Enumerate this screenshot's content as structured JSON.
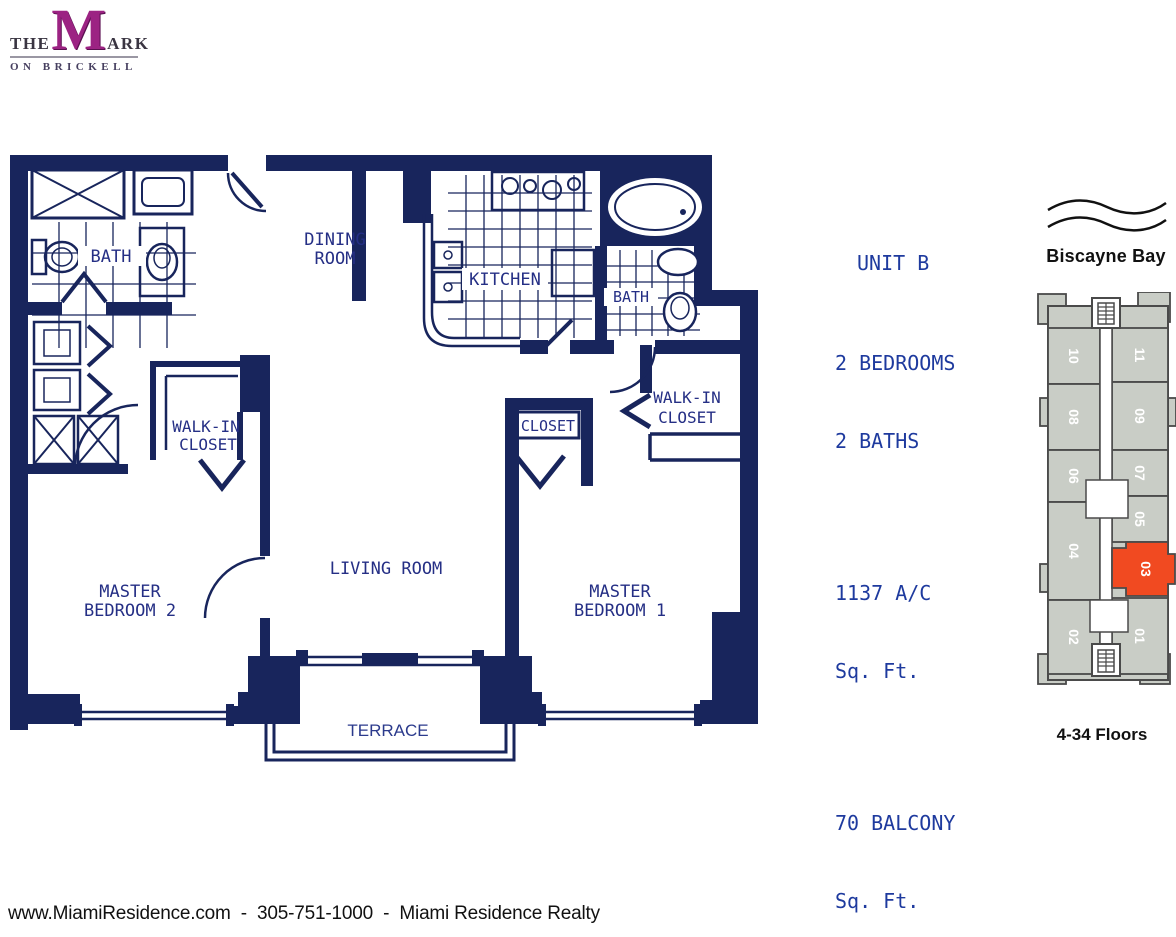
{
  "logo": {
    "word_the": "THE",
    "word_m": "M",
    "word_ark": "ARK",
    "tagline": "ON BRICKELL",
    "m_color": "#9c2383"
  },
  "unit_info": {
    "title": "UNIT B",
    "line_bedrooms": "2 BEDROOMS",
    "line_baths": "2 BATHS",
    "area_value": "1137 A/C",
    "area_unit": "Sq. Ft.",
    "balcony_value": "70 BALCONY",
    "balcony_unit": "Sq. Ft.",
    "text_color": "#1e3a9e"
  },
  "floor_plan": {
    "wall_color": "#18255c",
    "label_color": "#252f85",
    "labels": {
      "bath_left": "BATH",
      "dining_line1": "DINING",
      "dining_line2": "ROOM",
      "kitchen": "KITCHEN",
      "bath_right": "BATH",
      "wic_left_line1": "WALK-IN",
      "wic_left_line2": "CLOSET",
      "closet": "CLOSET",
      "wic_right_line1": "WALK-IN",
      "wic_right_line2": "CLOSET",
      "mb2_line1": "MASTER",
      "mb2_line2": "BEDROOM 2",
      "living": "LIVING ROOM",
      "mb1_line1": "MASTER",
      "mb1_line2": "BEDROOM 1",
      "terrace": "TERRACE"
    }
  },
  "key_plan": {
    "bay_label": "Biscayne Bay",
    "floors_label": "4-34 Floors",
    "highlighted_unit": "03",
    "highlight_color": "#f14a21",
    "building_fill": "#c9cdc6",
    "outline_color": "#4a4a4a",
    "units": [
      "10",
      "11",
      "08",
      "09",
      "06",
      "07",
      "04",
      "05",
      "03",
      "02",
      "01"
    ]
  },
  "footer": {
    "contact_line": "www.MiamiResidence.com  -  305-751-1000  -  Miami Residence Realty"
  }
}
